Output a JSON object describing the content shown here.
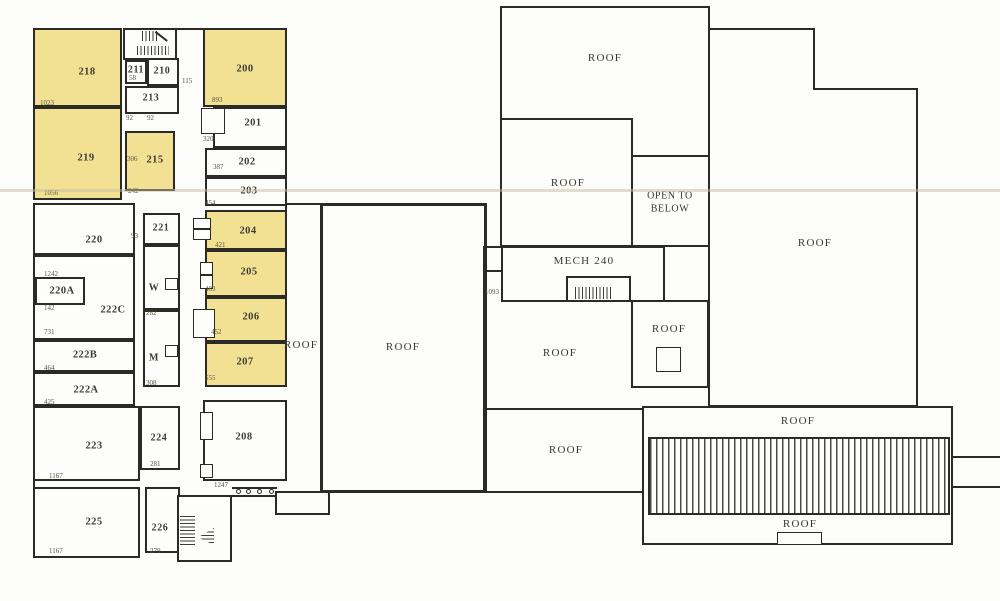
{
  "plan": {
    "rooms": {
      "r200": "200",
      "r201": "201",
      "r202": "202",
      "r203": "203",
      "r204": "204",
      "r205": "205",
      "r206": "206",
      "r207": "207",
      "r208": "208",
      "r210": "210",
      "r211": "211",
      "r213": "213",
      "r215": "215",
      "r218": "218",
      "r219": "219",
      "r220": "220",
      "r220a": "220A",
      "r221": "221",
      "r222a": "222A",
      "r222b": "222B",
      "r222c": "222C",
      "r223": "223",
      "r224": "224",
      "r225": "225",
      "r226": "226"
    },
    "labels": {
      "roof": "ROOF",
      "open_to": "OPEN TO",
      "below": "BELOW",
      "mech": "MECH 240",
      "women": "W",
      "men": "M"
    },
    "dims": {
      "n58": "58",
      "n92a": "92",
      "n92b": "92",
      "n93": "93",
      "n115": "115",
      "n142": "142",
      "n242": "242",
      "n279": "279",
      "n281": "281",
      "n282": "282",
      "n306": "306",
      "n308": "308",
      "n320": "320",
      "n387": "387",
      "n421": "421",
      "n425": "425",
      "n452": "452",
      "n454": "454",
      "n464": "464",
      "n483": "483",
      "n555": "555",
      "n731": "731",
      "n893": "893",
      "n1023": "1023",
      "n1056": "1056",
      "n1093": "1093",
      "n1167a": "1167",
      "n1167b": "1167",
      "n1242": "1242",
      "n1247": "1247"
    },
    "highlighted_rooms": [
      "200",
      "204",
      "205",
      "206",
      "207",
      "215",
      "218",
      "219"
    ],
    "colors": {
      "highlight": "#F3E193",
      "wall": "#2B2A27",
      "paper": "#FCFCFA"
    }
  }
}
